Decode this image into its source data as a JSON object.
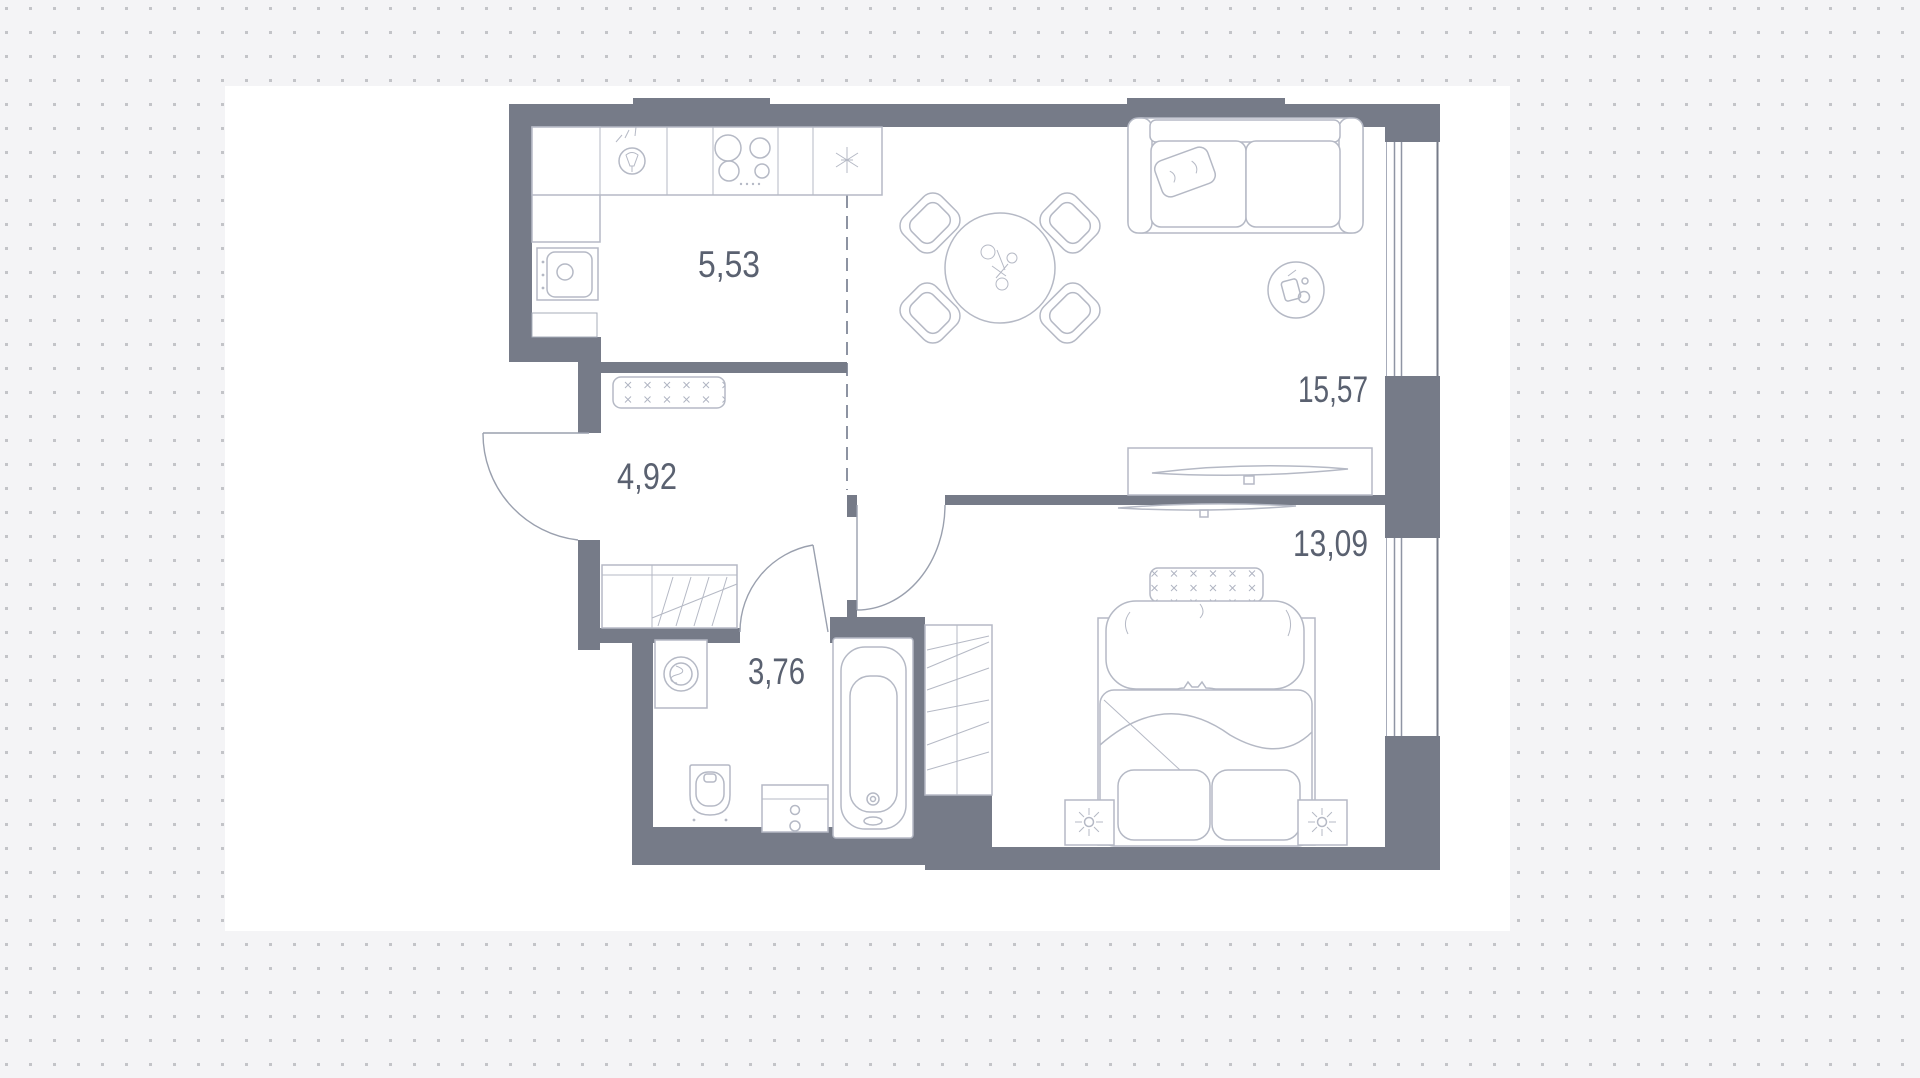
{
  "plan": {
    "type": "apartment-floor-plan",
    "rooms": [
      {
        "name": "kitchen",
        "area": "5,53"
      },
      {
        "name": "hallway",
        "area": "4,92"
      },
      {
        "name": "living-room",
        "area": "15,57"
      },
      {
        "name": "bedroom",
        "area": "13,09"
      },
      {
        "name": "bathroom",
        "area": "3,76"
      }
    ],
    "furniture_icons": [
      "cooker-hood-icon",
      "stove-burners-icon",
      "kitchen-sink-icon",
      "flue-marker-icon",
      "dining-table-icon",
      "dining-chair-icon",
      "sofa-icon",
      "throw-pillow-icon",
      "decor-plant-icon",
      "tv-console-icon",
      "tv-icon",
      "wall-tv-icon",
      "hall-bench-icon",
      "hall-wardrobe-icon",
      "built-in-closet-icon",
      "entry-door-icon",
      "bathroom-door-icon",
      "bedroom-door-icon",
      "washing-machine-icon",
      "toilet-icon",
      "vanity-sink-icon",
      "bathtub-icon",
      "bedroom-bench-icon",
      "double-bed-icon",
      "sleeping-cat-icon",
      "nightstand-lamp-icon",
      "window-icon",
      "zone-divider-dashed-line"
    ],
    "colors": {
      "background": "#f4f4f6",
      "dot": "#c3c4c8",
      "artboard": "#ffffff",
      "wall": "#767b88",
      "furniture_line": "#b5b9c5",
      "door_line": "#9aa0ae",
      "label": "#5a6170"
    }
  }
}
